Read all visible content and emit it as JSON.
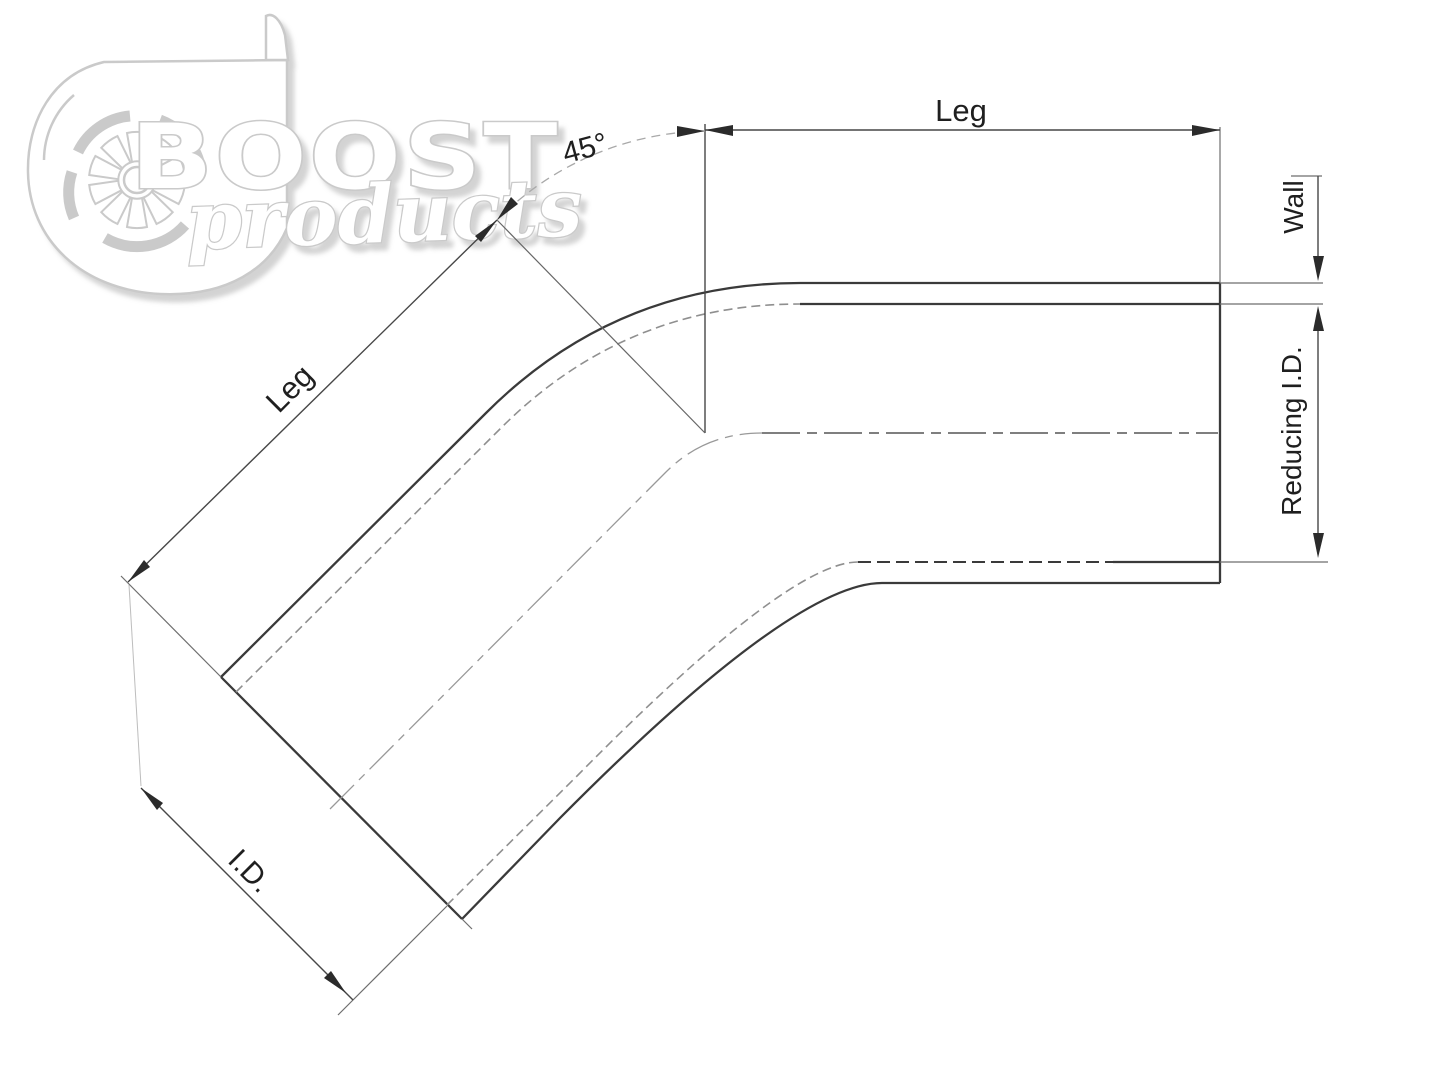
{
  "watermark": {
    "brand": "BOOST",
    "brand_sub": "products",
    "icon": "turbocharger-icon",
    "color": "#cacaca"
  },
  "labels": {
    "angle": "45°",
    "leg_top": "Leg",
    "leg_diagonal": "Leg",
    "wall": "Wall",
    "reducing_id": "Reducing I.D.",
    "inner_diameter": "I.D."
  },
  "colors": {
    "background": "#ffffff",
    "outline": "#3a3a3a",
    "dimension": "#474747",
    "hidden_line": "#8f8f8f",
    "centerline_gray": "#999999",
    "centerline_dark": "#555555",
    "watermark": "#cacaca"
  }
}
